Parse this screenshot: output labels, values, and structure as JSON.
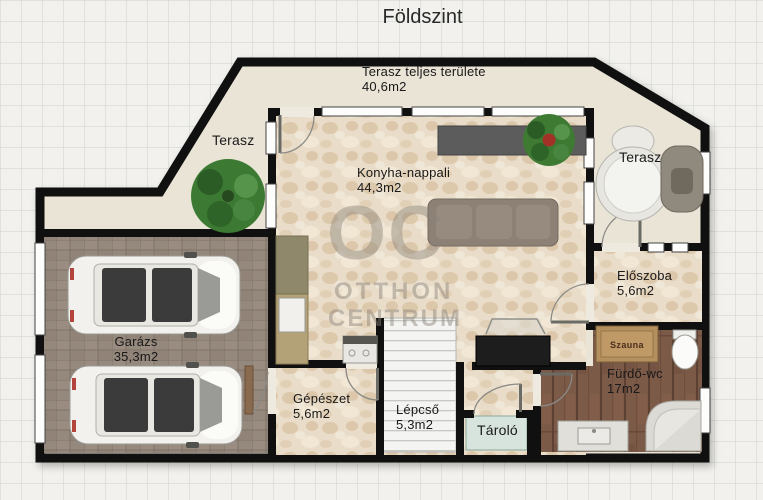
{
  "title": "Földszint",
  "watermark": {
    "logo": "OC",
    "line1": "OTTHON",
    "line2": "CENTRUM"
  },
  "rooms": {
    "terrace_total": {
      "name": "Terasz teljes területe",
      "area": "40,6m2"
    },
    "terrace_left": {
      "name": "Terasz"
    },
    "terrace_right": {
      "name": "Terasz"
    },
    "kitchen_living": {
      "name": "Konyha-nappali",
      "area": "44,3m2"
    },
    "hall": {
      "name": "Előszoba",
      "area": "5,6m2"
    },
    "garage": {
      "name": "Garázs",
      "area": "35,3m2"
    },
    "mechanical": {
      "name": "Gépészet",
      "area": "5,6m2"
    },
    "stairs": {
      "name": "Lépcső",
      "area": "5,3m2"
    },
    "storage": {
      "name": "Tároló"
    },
    "bathroom": {
      "name": "Fürdő-wc",
      "area": "17m2"
    },
    "sauna": {
      "name": "Szauna"
    }
  },
  "colors": {
    "wall": "#101010",
    "terrace_floor": "#eae4d7",
    "stone_floor": "#e9ddc9",
    "garage_floor": "#95887d",
    "wood_floor": "#7c5a48",
    "stairs_floor": "#f4f4f2",
    "storage_floor": "#d6e4dd",
    "sauna_box": "#b5905f",
    "plant": "#3c7a33",
    "watermark": "#8a8178"
  }
}
